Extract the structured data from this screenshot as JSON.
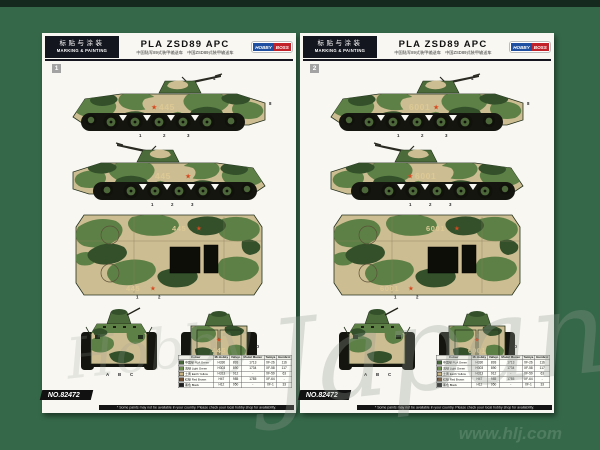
{
  "window": {
    "bg": "#356849",
    "top_strip": "#16291f",
    "page_bg": "#f8f7f2"
  },
  "header": {
    "cn_label": "标贴与涂装",
    "en_label": "MARKING & PAINTING",
    "title": "PLA ZSD89 APC",
    "subtitle": "中国陆军89式装甲输送车　中国ZSD89式装甲输送车",
    "logo_left": "HOBBY",
    "logo_right": "BOSS"
  },
  "pages": [
    {
      "step": "1",
      "marking": "445"
    },
    {
      "step": "2",
      "marking": "6001"
    }
  ],
  "star": "★",
  "product_no": "NO.82472",
  "paint_table": {
    "columns": [
      "Colour",
      "Mr.Hobby",
      "Vallejo",
      "Model Master",
      "Tamiya",
      "Humbrol"
    ],
    "rows": [
      {
        "swatch": "#47663a",
        "name": "中国绿 PLA Green",
        "mr_hobby": "H330",
        "vallejo": "893",
        "model_master": "1713",
        "tamiya": "XF-26",
        "humbrol": "116"
      },
      {
        "swatch": "#6d8a4d",
        "name": "浅绿 Light Green",
        "mr_hobby": "H303",
        "vallejo": "890",
        "model_master": "1734",
        "tamiya": "XF-58",
        "humbrol": "117"
      },
      {
        "swatch": "#c9b383",
        "name": "土黄 Earth Yellow",
        "mr_hobby": "H313",
        "vallejo": "912",
        "model_master": "-",
        "tamiya": "XF-59",
        "humbrol": "63"
      },
      {
        "swatch": "#6e4a2f",
        "name": "红棕 Red Brown",
        "mr_hobby": "H47",
        "vallejo": "985",
        "model_master": "1785",
        "tamiya": "XF-64",
        "humbrol": "-"
      },
      {
        "swatch": "#1c1c1c",
        "name": "黑色 Black",
        "mr_hobby": "H12",
        "vallejo": "950",
        "model_master": "-",
        "tamiya": "XF-1",
        "humbrol": "33"
      }
    ]
  },
  "footnote": "* Some paints may not be available in your country. Please check your local hobby shop for availability.",
  "callouts": [
    "1",
    "2",
    "3",
    "4",
    "5",
    "8",
    "A",
    "B",
    "C",
    "D"
  ],
  "watermark": {
    "brand": "Hobby",
    "big": "Japan",
    "url": "www.hlj.com"
  },
  "colors": {
    "camo_tan": "#cdbd92",
    "camo_green": "#5d8046",
    "camo_dark": "#33502b",
    "track_black": "#15150f",
    "marking_red": "#d8481f",
    "marking_tan": "#dcc995"
  }
}
